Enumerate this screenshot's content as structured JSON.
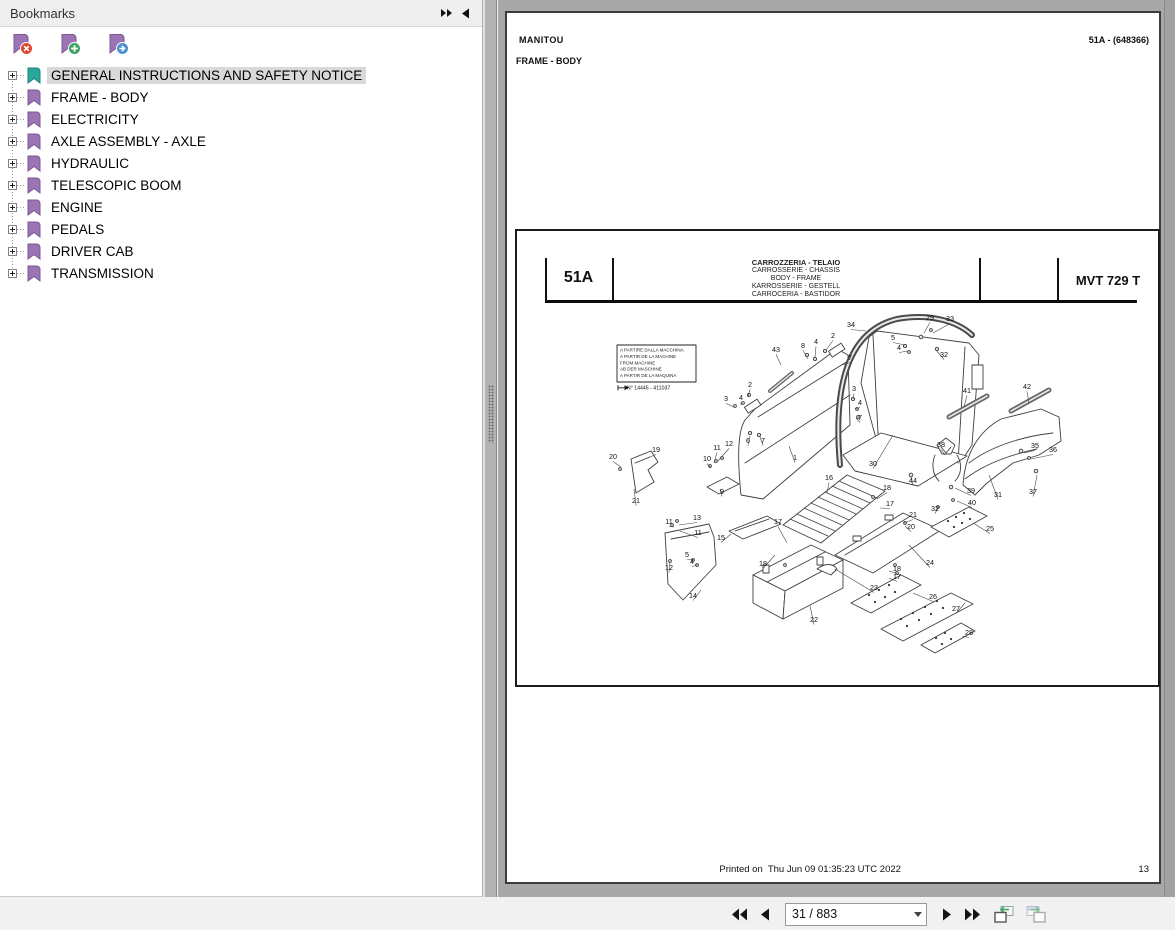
{
  "colors": {
    "bookmark_purple": "#9b74b4",
    "bookmark_purple_stroke": "#7b5796",
    "bookmark_selected": "#2aa79b",
    "bookmark_selected_stroke": "#1d8177",
    "badge_delete": "#e0482e",
    "badge_add": "#3da263",
    "badge_next": "#4e8fd0",
    "selection_bg": "#d9d9d9",
    "doc_background": "#a8a8a8"
  },
  "bookmarks_panel": {
    "title": "Bookmarks",
    "header_icons": [
      "collapse-all-icon",
      "dock-left-icon"
    ],
    "toolbar_icons": [
      "bookmark-delete-icon",
      "bookmark-add-icon",
      "bookmark-next-icon"
    ],
    "items": [
      {
        "label": "GENERAL INSTRUCTIONS AND SAFETY NOTICE",
        "selected": true
      },
      {
        "label": "FRAME - BODY",
        "selected": false
      },
      {
        "label": "ELECTRICITY",
        "selected": false
      },
      {
        "label": "AXLE ASSEMBLY - AXLE",
        "selected": false
      },
      {
        "label": "HYDRAULIC",
        "selected": false
      },
      {
        "label": "TELESCOPIC BOOM",
        "selected": false
      },
      {
        "label": "ENGINE",
        "selected": false
      },
      {
        "label": "PEDALS",
        "selected": false
      },
      {
        "label": "DRIVER CAB",
        "selected": false
      },
      {
        "label": "TRANSMISSION",
        "selected": false
      }
    ]
  },
  "document": {
    "page_header": {
      "brand": "MANITOU",
      "section": "FRAME - BODY",
      "ref": "51A - (648366)"
    },
    "diagram": {
      "section_code": "51A",
      "model": "MVT 729 T",
      "title_lines": [
        "CARROZZERIA - TELAIO",
        "CARROSSERIE - CHASSIS",
        "BODY - FRAME",
        "KARROSSERIE - GESTELL",
        "CARROCERIA - BASTIDOR"
      ],
      "note_lines": [
        "A PARTIRE DALLA MACCHINA",
        "A PARTIR DE LA MACHINE",
        "FROM MACHINE",
        "AB DER MASCHINE",
        "A PARTIR DE LA MAQUINA"
      ],
      "note_serial": "N° 14445 - 411037",
      "callouts": [
        {
          "t": "34",
          "x": 334,
          "y": 24,
          "lx": 349,
          "ly": 28
        },
        {
          "t": "29",
          "x": 413,
          "y": 17,
          "lx": 407,
          "ly": 30
        },
        {
          "t": "33",
          "x": 433,
          "y": 18,
          "lx": 416,
          "ly": 30
        },
        {
          "t": "43",
          "x": 259,
          "y": 49,
          "lx": 264,
          "ly": 62
        },
        {
          "t": "8",
          "x": 286,
          "y": 45,
          "lx": 291,
          "ly": 56
        },
        {
          "t": "4",
          "x": 299,
          "y": 41,
          "lx": 298,
          "ly": 54
        },
        {
          "t": "2",
          "x": 316,
          "y": 35,
          "lx": 309,
          "ly": 47
        },
        {
          "t": "7",
          "x": 333,
          "y": 57,
          "lx": 325,
          "ly": 62
        },
        {
          "t": "5",
          "x": 376,
          "y": 37,
          "lx": 388,
          "ly": 42
        },
        {
          "t": "4",
          "x": 382,
          "y": 47,
          "lx": 391,
          "ly": 48
        },
        {
          "t": "32",
          "x": 427,
          "y": 54,
          "lx": 419,
          "ly": 47
        },
        {
          "t": "2",
          "x": 233,
          "y": 84,
          "lx": 231,
          "ly": 94
        },
        {
          "t": "3",
          "x": 209,
          "y": 98,
          "lx": 217,
          "ly": 104
        },
        {
          "t": "4",
          "x": 224,
          "y": 97,
          "lx": 224,
          "ly": 102
        },
        {
          "t": "3",
          "x": 337,
          "y": 88,
          "lx": 336,
          "ly": 96
        },
        {
          "t": "4",
          "x": 343,
          "y": 102,
          "lx": 338,
          "ly": 106
        },
        {
          "t": "7",
          "x": 343,
          "y": 117,
          "lx": 339,
          "ly": 115
        },
        {
          "t": "6",
          "x": 231,
          "y": 140,
          "lx": 233,
          "ly": 133
        },
        {
          "t": "7",
          "x": 246,
          "y": 140,
          "lx": 243,
          "ly": 134
        },
        {
          "t": "1",
          "x": 278,
          "y": 157,
          "lx": 272,
          "ly": 143
        },
        {
          "t": "41",
          "x": 450,
          "y": 90,
          "lx": 447,
          "ly": 104
        },
        {
          "t": "42",
          "x": 510,
          "y": 86,
          "lx": 512,
          "ly": 100
        },
        {
          "t": "20",
          "x": 96,
          "y": 156,
          "lx": 104,
          "ly": 164
        },
        {
          "t": "19",
          "x": 139,
          "y": 149,
          "lx": 128,
          "ly": 156
        },
        {
          "t": "21",
          "x": 119,
          "y": 200,
          "lx": 117,
          "ly": 186
        },
        {
          "t": "10",
          "x": 190,
          "y": 158,
          "lx": 194,
          "ly": 165
        },
        {
          "t": "11",
          "x": 200,
          "y": 147,
          "lx": 197,
          "ly": 160
        },
        {
          "t": "12",
          "x": 212,
          "y": 143,
          "lx": 201,
          "ly": 158
        },
        {
          "t": "9",
          "x": 205,
          "y": 191,
          "lx": 203,
          "ly": 186
        },
        {
          "t": "30",
          "x": 356,
          "y": 163,
          "lx": 376,
          "ly": 132
        },
        {
          "t": "44",
          "x": 396,
          "y": 180,
          "lx": 394,
          "ly": 174
        },
        {
          "t": "38",
          "x": 424,
          "y": 144,
          "lx": 428,
          "ly": 152
        },
        {
          "t": "35",
          "x": 518,
          "y": 145,
          "lx": 507,
          "ly": 150
        },
        {
          "t": "36",
          "x": 536,
          "y": 149,
          "lx": 514,
          "ly": 156
        },
        {
          "t": "31",
          "x": 481,
          "y": 194,
          "lx": 472,
          "ly": 172
        },
        {
          "t": "37",
          "x": 516,
          "y": 191,
          "lx": 520,
          "ly": 172
        },
        {
          "t": "39",
          "x": 454,
          "y": 190,
          "lx": 438,
          "ly": 185
        },
        {
          "t": "40",
          "x": 455,
          "y": 202,
          "lx": 440,
          "ly": 198
        },
        {
          "t": "32",
          "x": 418,
          "y": 208,
          "lx": 421,
          "ly": 205
        },
        {
          "t": "16",
          "x": 312,
          "y": 177,
          "lx": 310,
          "ly": 190
        },
        {
          "t": "18",
          "x": 370,
          "y": 187,
          "lx": 360,
          "ly": 196
        },
        {
          "t": "17",
          "x": 373,
          "y": 203,
          "lx": 363,
          "ly": 205
        },
        {
          "t": "21",
          "x": 396,
          "y": 214,
          "lx": 387,
          "ly": 220
        },
        {
          "t": "20",
          "x": 394,
          "y": 226,
          "lx": 388,
          "ly": 223
        },
        {
          "t": "24",
          "x": 413,
          "y": 262,
          "lx": 392,
          "ly": 242
        },
        {
          "t": "25",
          "x": 473,
          "y": 228,
          "lx": 456,
          "ly": 220
        },
        {
          "t": "11",
          "x": 152,
          "y": 221,
          "lx": 157,
          "ly": 224
        },
        {
          "t": "13",
          "x": 180,
          "y": 217,
          "lx": 162,
          "ly": 222
        },
        {
          "t": "11",
          "x": 181,
          "y": 232,
          "lx": 163,
          "ly": 228
        },
        {
          "t": "15",
          "x": 204,
          "y": 237,
          "lx": 214,
          "ly": 231
        },
        {
          "t": "5",
          "x": 170,
          "y": 254,
          "lx": 176,
          "ly": 257
        },
        {
          "t": "4",
          "x": 175,
          "y": 261,
          "lx": 180,
          "ly": 262
        },
        {
          "t": "12",
          "x": 152,
          "y": 267,
          "lx": 153,
          "ly": 259
        },
        {
          "t": "14",
          "x": 176,
          "y": 295,
          "lx": 184,
          "ly": 287
        },
        {
          "t": "17",
          "x": 261,
          "y": 221,
          "lx": 270,
          "ly": 240
        },
        {
          "t": "18",
          "x": 246,
          "y": 263,
          "lx": 258,
          "ly": 252
        },
        {
          "t": "23",
          "x": 357,
          "y": 287,
          "lx": 318,
          "ly": 266
        },
        {
          "t": "18",
          "x": 380,
          "y": 268,
          "lx": 372,
          "ly": 268
        },
        {
          "t": "17",
          "x": 380,
          "y": 276,
          "lx": 372,
          "ly": 275
        },
        {
          "t": "22",
          "x": 297,
          "y": 319,
          "lx": 293,
          "ly": 303
        },
        {
          "t": "26",
          "x": 416,
          "y": 296,
          "lx": 396,
          "ly": 290
        },
        {
          "t": "27",
          "x": 439,
          "y": 308,
          "lx": 448,
          "ly": 300
        },
        {
          "t": "28",
          "x": 452,
          "y": 332,
          "lx": 445,
          "ly": 333
        }
      ]
    },
    "footer": {
      "printed": "Printed on  Thu Jun 09 01:35:23 UTC 2022",
      "page_number": "13"
    }
  },
  "nav_toolbar": {
    "page_field": "31 / 883",
    "icons": [
      "first-page-icon",
      "previous-page-icon",
      "page-number-combobox",
      "next-page-icon",
      "last-page-icon",
      "previous-view-icon",
      "next-view-icon"
    ]
  }
}
